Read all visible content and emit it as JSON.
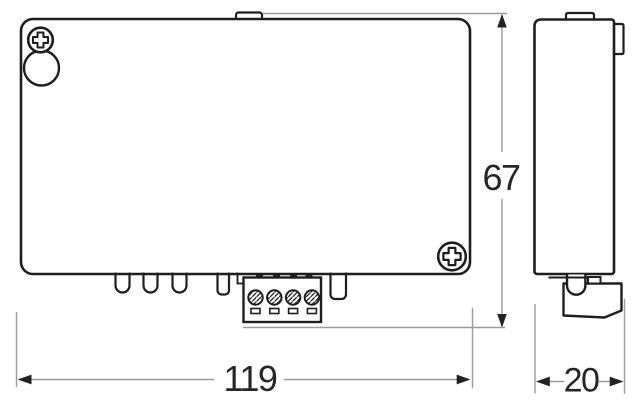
{
  "drawing": {
    "type": "technical-dimension-drawing",
    "labels": {
      "width": "119",
      "height": "67",
      "depth": "20"
    },
    "colors": {
      "outline": "#1e1e1e",
      "dimension_line": "#9a9a9a",
      "label_text": "#262626",
      "background": "#ffffff"
    },
    "icons": {
      "screw_top_left": "phillips-screw-icon",
      "screw_bottom_right": "phillips-screw-icon",
      "keyhole": "keyhole-slot",
      "terminal_screws": "slotted-terminal-screw-icon"
    }
  }
}
